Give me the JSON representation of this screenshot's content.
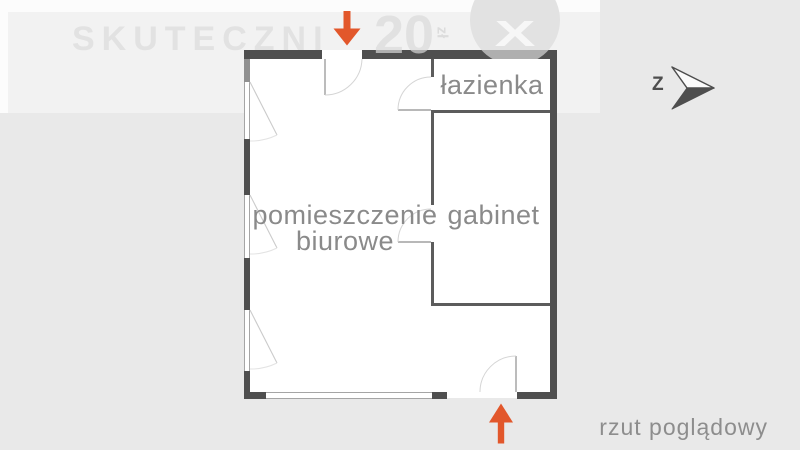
{
  "watermark": {
    "brand": "SKUTECZNI",
    "number": "20",
    "currency_note": "zł",
    "badge_letter": "X"
  },
  "compass": {
    "north_letter": "Z"
  },
  "plan": {
    "rooms": {
      "office_line1": "pomieszczenie",
      "office_line2": "biurowe",
      "cabinet": "gabinet",
      "bathroom": "łazienka"
    }
  },
  "caption": "rzut poglądowy",
  "colors": {
    "accent_orange": "#e2572b",
    "wall_dark": "#4f4f4f",
    "wall_interior": "#5c5c5c",
    "label_gray": "#8a8a8a",
    "background": "#e9e9e9"
  }
}
